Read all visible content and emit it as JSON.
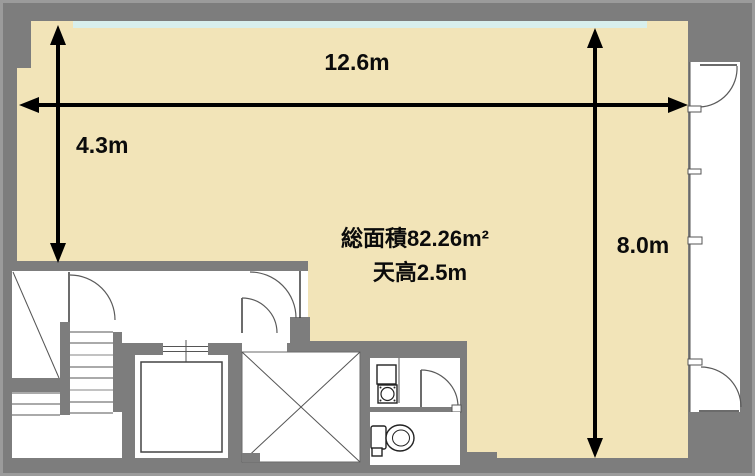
{
  "plan": {
    "type": "floor-plan",
    "labels": {
      "width": "12.6m",
      "height_left": "4.3m",
      "height_right": "8.0m",
      "area": "総面積82.26m²",
      "ceiling": "天高2.5m"
    },
    "colors": {
      "wall": "#7d7d7d",
      "wall_edge": "#9b9b9b",
      "room": "#f2e4b8",
      "window": "#d8efed",
      "white": "#ffffff"
    }
  }
}
